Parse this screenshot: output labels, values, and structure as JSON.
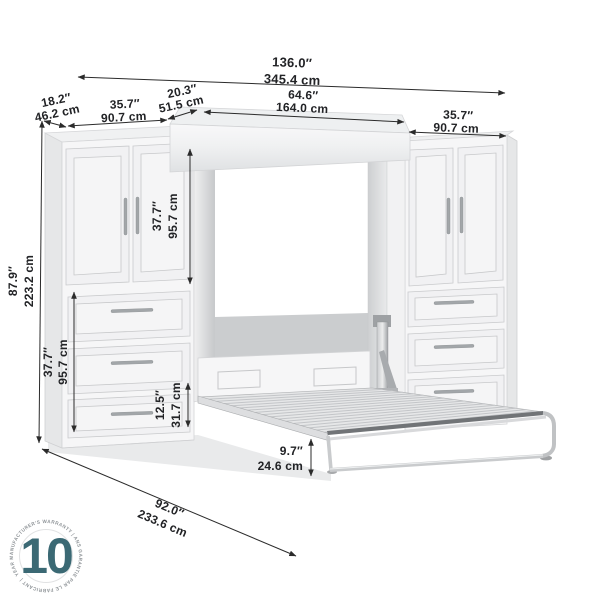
{
  "title": "Murphy bed with two storage cabinets — dimension diagram",
  "dims": {
    "overall_width": {
      "in": "136.0″",
      "cm": "345.4 cm"
    },
    "left_depth": {
      "in": "18.2″",
      "cm": "46.2 cm"
    },
    "left_width": {
      "in": "35.7″",
      "cm": "90.7 cm"
    },
    "top_depth": {
      "in": "20.3″",
      "cm": "51.5 cm"
    },
    "bed_width": {
      "in": "64.6″",
      "cm": "164.0 cm"
    },
    "right_width": {
      "in": "35.7″",
      "cm": "90.7 cm"
    },
    "overall_height": {
      "in": "87.9″",
      "cm": "223.2 cm"
    },
    "door_height": {
      "in": "37.7″",
      "cm": "95.7 cm"
    },
    "drawer_height": {
      "in": "37.7″",
      "cm": "95.7 cm"
    },
    "bottom_drawer_height": {
      "in": "12.5″",
      "cm": "31.7 cm"
    },
    "bed_frame_height": {
      "in": "9.7″",
      "cm": "24.6 cm"
    },
    "open_depth": {
      "in": "92.0″",
      "cm": "233.6 cm"
    }
  },
  "badge": {
    "number": "10",
    "ring_text": "YEAR MANUFACTURER'S WARRANTY   |   ANS GARANTIE PAR LE FABRICANT   |",
    "accent_color": "#3b6974",
    "ring_text_color": "#8f9498"
  },
  "colors": {
    "dimension_line": "#2b2b2b"
  }
}
